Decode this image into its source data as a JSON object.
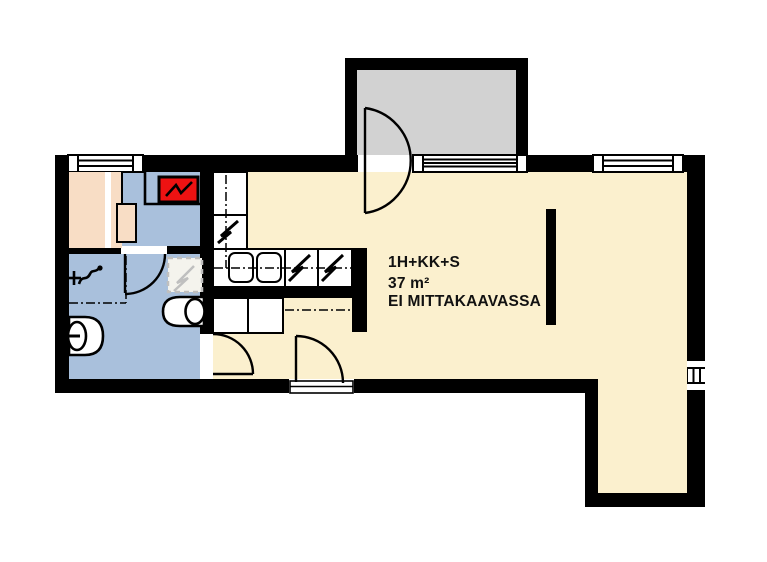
{
  "plan_labels": {
    "type": "1H+KK+S",
    "area": "37 m²",
    "scale_note": "EI MITTAKAAVASSA"
  },
  "colors": {
    "wall": "#000000",
    "floor-main": "#fbf0ce",
    "floor-wet": "#a9c0dc",
    "bench": "#f8ddc5",
    "balcony": "#d2d2d2",
    "stove": "#ee1212",
    "reservation": "#bfbfbf",
    "reservation-fill": "#f4f3ed",
    "paper": "#ffffff",
    "text": "#111111"
  },
  "icons": {
    "sauna-stove-icon": "red box with black zigzag bolt",
    "appliance-icon": "white box with black zigzag bolt",
    "shower-icon": "cross with squiggle arrow and dot",
    "door-icon": "leaf line with quarter-circle swing arc",
    "balcony-door-icon": "leaf line with half-circle swing arc",
    "window-icon": "white bar with glazing lines",
    "vent-grille-icon": "white bars on wall",
    "reservation-icon": "gray dashed square with dashed zigzag"
  }
}
